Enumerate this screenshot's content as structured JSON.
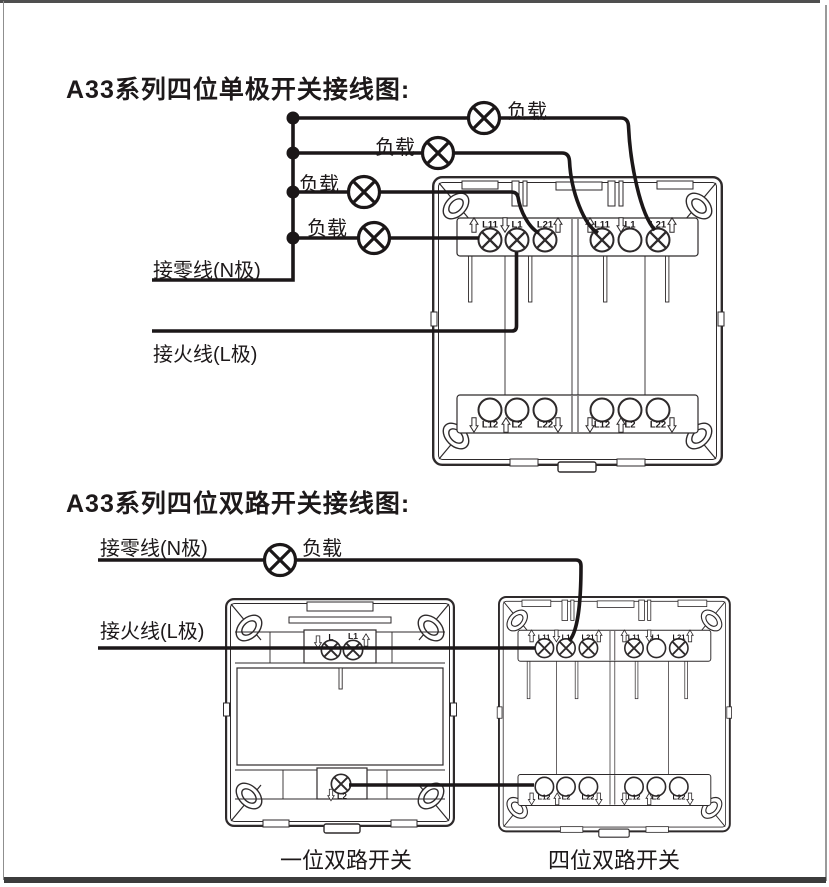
{
  "colors": {
    "ink": "#1d191a",
    "artwork_stroke": "#2e2a2b",
    "wire": "#1b1718",
    "frame_dark": "#464646",
    "frame_light": "#909090"
  },
  "diagram1": {
    "title": "A33系列四位单极开关接线图:",
    "load_labels": [
      "负载",
      "负载",
      "负载",
      "负载"
    ],
    "neutral_label": "接零线(N极)",
    "live_label": "接火线(L极)",
    "switch4": {
      "top_terminals": [
        "L11",
        "L1",
        "L21",
        "L11",
        "L1",
        "L21"
      ],
      "bottom_terminals": [
        "L12",
        "L2",
        "L22",
        "L12",
        "L2",
        "L22"
      ]
    }
  },
  "diagram2": {
    "title": "A33系列四位双路开关接线图:",
    "neutral_label": "接零线(N极)",
    "live_label": "接火线(L极)",
    "load_label": "负载",
    "switch1": {
      "caption": "一位双路开关",
      "top_terminals": [
        "L",
        "L1"
      ],
      "bottom_terminals": [
        "L2"
      ]
    },
    "switch4": {
      "caption": "四位双路开关",
      "top_terminals": [
        "L11",
        "L1",
        "L21",
        "L11",
        "L1",
        "L21"
      ],
      "bottom_terminals": [
        "L12",
        "L2",
        "L22",
        "L12",
        "L2",
        "L22"
      ]
    }
  }
}
